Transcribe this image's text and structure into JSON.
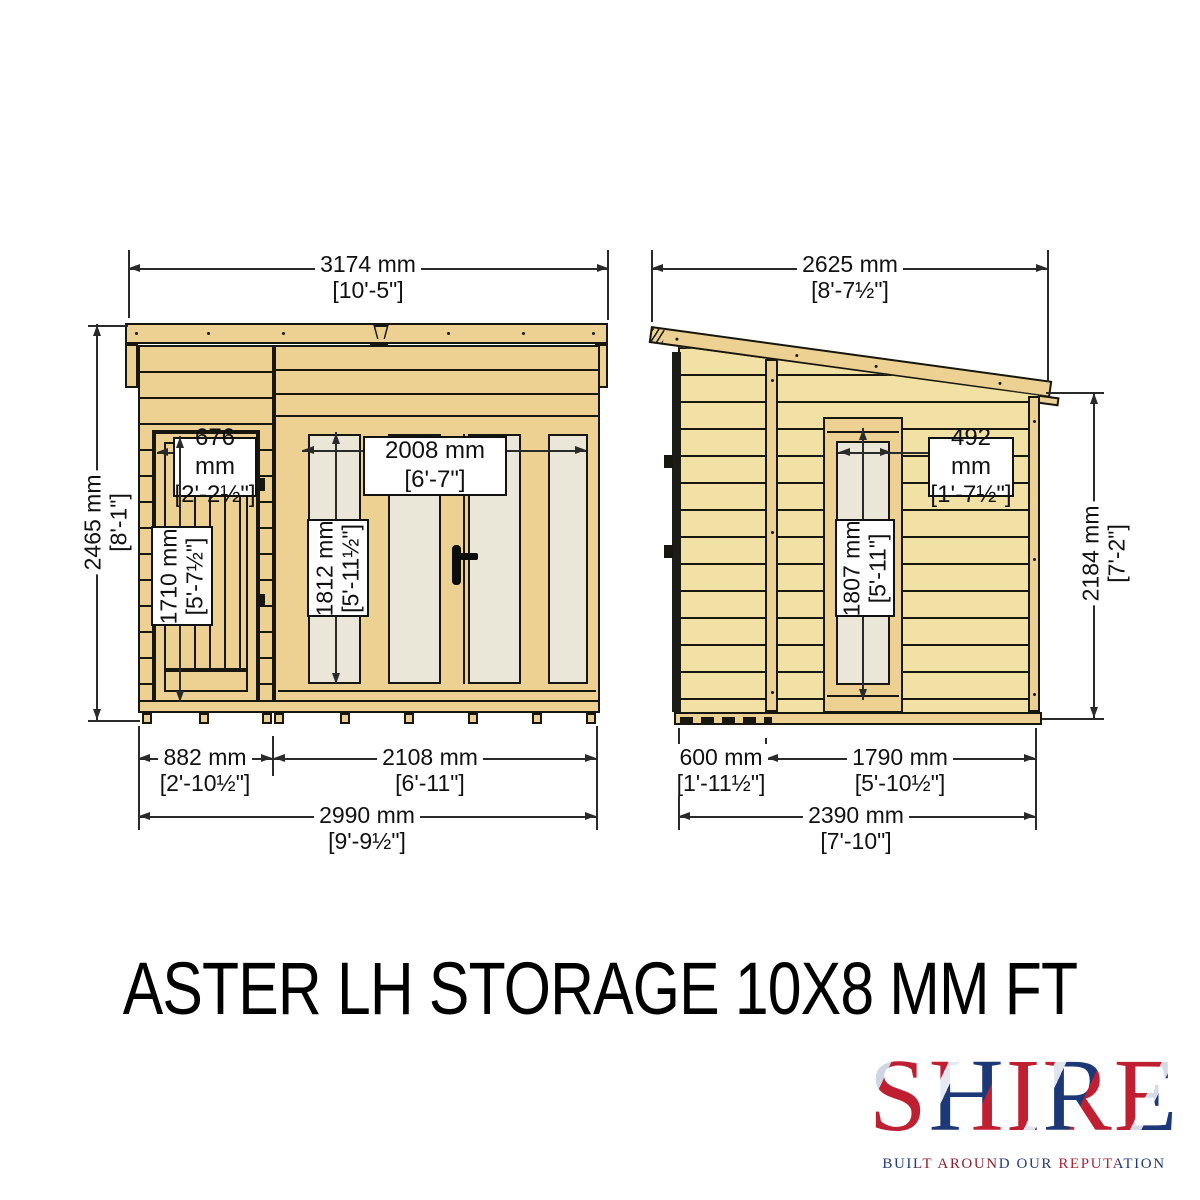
{
  "title": "ASTER LH STORAGE 10X8 MM FT",
  "brand": {
    "name": "SHIRE",
    "tagline": "BUILT AROUND OUR REPUTATION"
  },
  "front": {
    "roof_w": {
      "mm": "3174 mm",
      "ft": "[10'-5\"]"
    },
    "height": {
      "mm": "2465 mm",
      "ft": "[8'-1\"]"
    },
    "door_w": {
      "mm": "676 mm",
      "ft": "[2'-2½\"]"
    },
    "door_h": {
      "mm": "1710 mm",
      "ft": "[5'-7½\"]"
    },
    "glaze_w": {
      "mm": "2008 mm",
      "ft": "[6'-7\"]"
    },
    "glaze_h": {
      "mm": "1812 mm",
      "ft": "[5'-11½\"]"
    },
    "base_left": {
      "mm": "882 mm",
      "ft": "[2'-10½\"]"
    },
    "base_right": {
      "mm": "2108 mm",
      "ft": "[6'-11\"]"
    },
    "base_total": {
      "mm": "2990 mm",
      "ft": "[9'-9½\"]"
    }
  },
  "side": {
    "roof_w": {
      "mm": "2625 mm",
      "ft": "[8'-7½\"]"
    },
    "height": {
      "mm": "2184 mm",
      "ft": "[7'-2\"]"
    },
    "win_w": {
      "mm": "492 mm",
      "ft": "[1'-7½\"]"
    },
    "win_h": {
      "mm": "1807 mm",
      "ft": "[5'-11\"]"
    },
    "base_left": {
      "mm": "600 mm",
      "ft": "[1'-11½\"]"
    },
    "base_right": {
      "mm": "1790 mm",
      "ft": "[5'-10½\"]"
    },
    "base_total": {
      "mm": "2390 mm",
      "ft": "[7'-10\"]"
    }
  },
  "colors": {
    "wood": "#ecd192",
    "wood_light": "#f2e1a4",
    "glass": "#eae6d8",
    "outline": "#17170f",
    "dim_line": "#2a2a2a",
    "brand_red": "#c01f31",
    "brand_blue": "#1c3876"
  }
}
